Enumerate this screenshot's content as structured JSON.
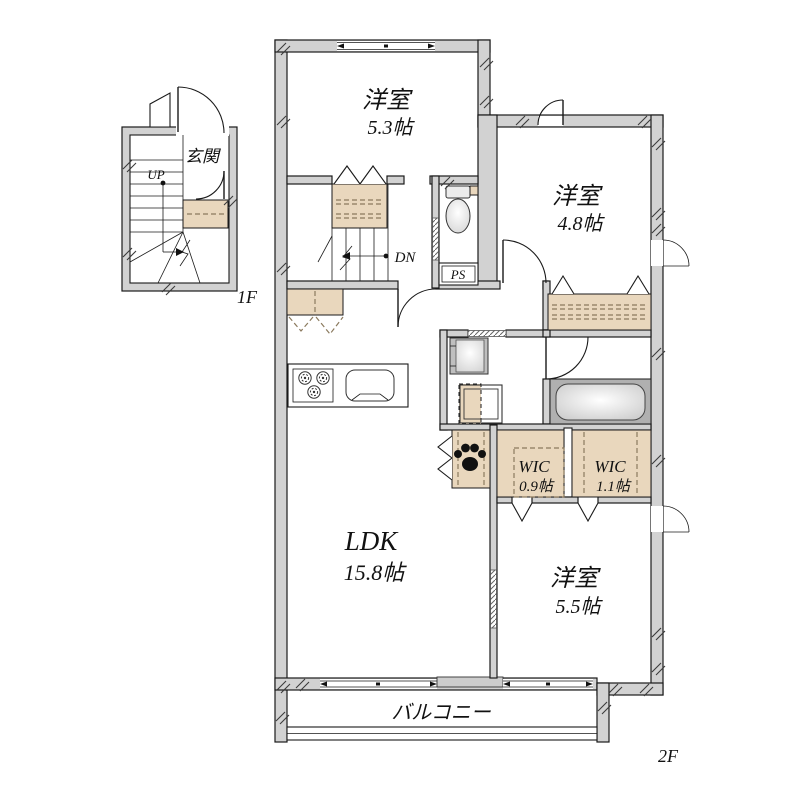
{
  "floor1": {
    "floor_label": "1F",
    "entrance_label": "玄関",
    "up_label": "UP"
  },
  "floor2": {
    "floor_label": "2F",
    "bedroom_53": {
      "name": "洋室",
      "area": "5.3帖"
    },
    "bedroom_48": {
      "name": "洋室",
      "area": "4.8帖"
    },
    "bedroom_55": {
      "name": "洋室",
      "area": "5.5帖"
    },
    "ldk": {
      "name": "LDK",
      "area": "15.8帖"
    },
    "wic_09": {
      "name": "WIC",
      "area": "0.9帖"
    },
    "wic_11": {
      "name": "WIC",
      "area": "1.1帖"
    },
    "balcony_label": "バルコニー",
    "pipe_space_label": "PS",
    "down_label": "DN"
  },
  "colors": {
    "wall": "#d2d2d2",
    "closet": "#e9d7bd",
    "tub_surround": "#b0b0b0",
    "outline": "#1a1a1a"
  }
}
